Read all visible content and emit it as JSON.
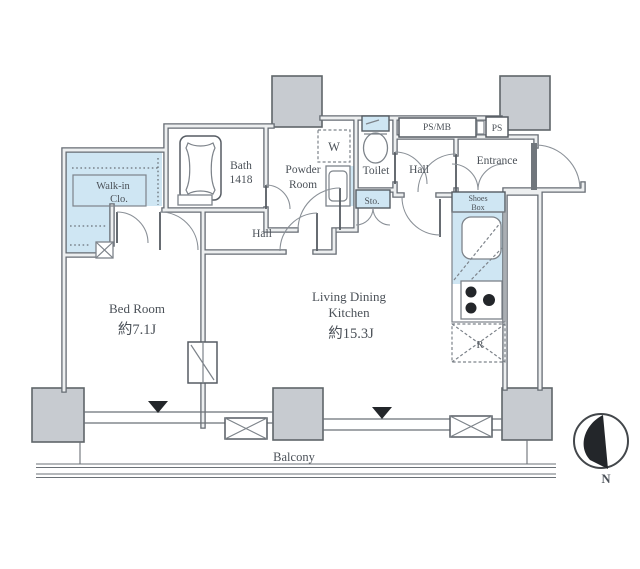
{
  "colors": {
    "room_highlight": "#cfe6f3",
    "pillar": "#c7cbd0",
    "wall": "#666c73",
    "text": "#4b5158"
  },
  "rooms": {
    "walk_in_closet": {
      "line1": "Walk-in",
      "line2": "Clo."
    },
    "bath": {
      "name": "Bath",
      "size": "1418"
    },
    "powder_room": {
      "line1": "Powder",
      "line2": "Room"
    },
    "washer": {
      "label": "W"
    },
    "toilet": {
      "label": "Toilet"
    },
    "upper_hall": {
      "label": "Hall"
    },
    "lower_hall": {
      "label": "Hall"
    },
    "ps_mb": {
      "label": "PS/MB"
    },
    "ps": {
      "label": "PS"
    },
    "entrance": {
      "label": "Entrance"
    },
    "shoes_box": {
      "line1": "Shoes",
      "line2": "Box"
    },
    "storage": {
      "label": "Sto."
    },
    "bedroom": {
      "name": "Bed Room",
      "area": "約7.1J"
    },
    "living_dining_kitchen": {
      "line1": "Living Dining",
      "line2": "Kitchen",
      "area": "約15.3J"
    },
    "refrigerator": {
      "label": "R"
    },
    "balcony": {
      "label": "Balcony"
    }
  },
  "compass": {
    "north_label": "N"
  }
}
